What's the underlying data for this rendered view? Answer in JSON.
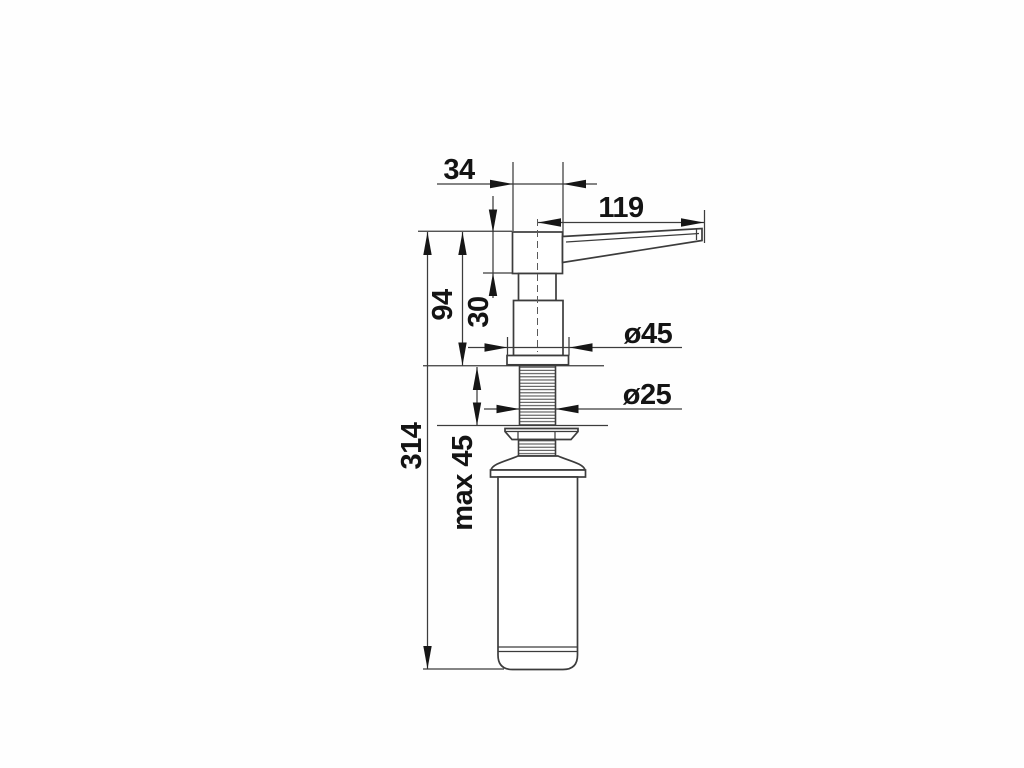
{
  "labels": {
    "head_width": "34",
    "spout_reach": "119",
    "height_above_counter": "94",
    "head_height": "30",
    "flange_diameter": "ø45",
    "thread_diameter": "ø25",
    "max_counter_thickness": "max 45",
    "total_height": "314"
  },
  "colors": {
    "line": "#3c3c3c",
    "text": "#141414",
    "background": "#fefefe"
  }
}
